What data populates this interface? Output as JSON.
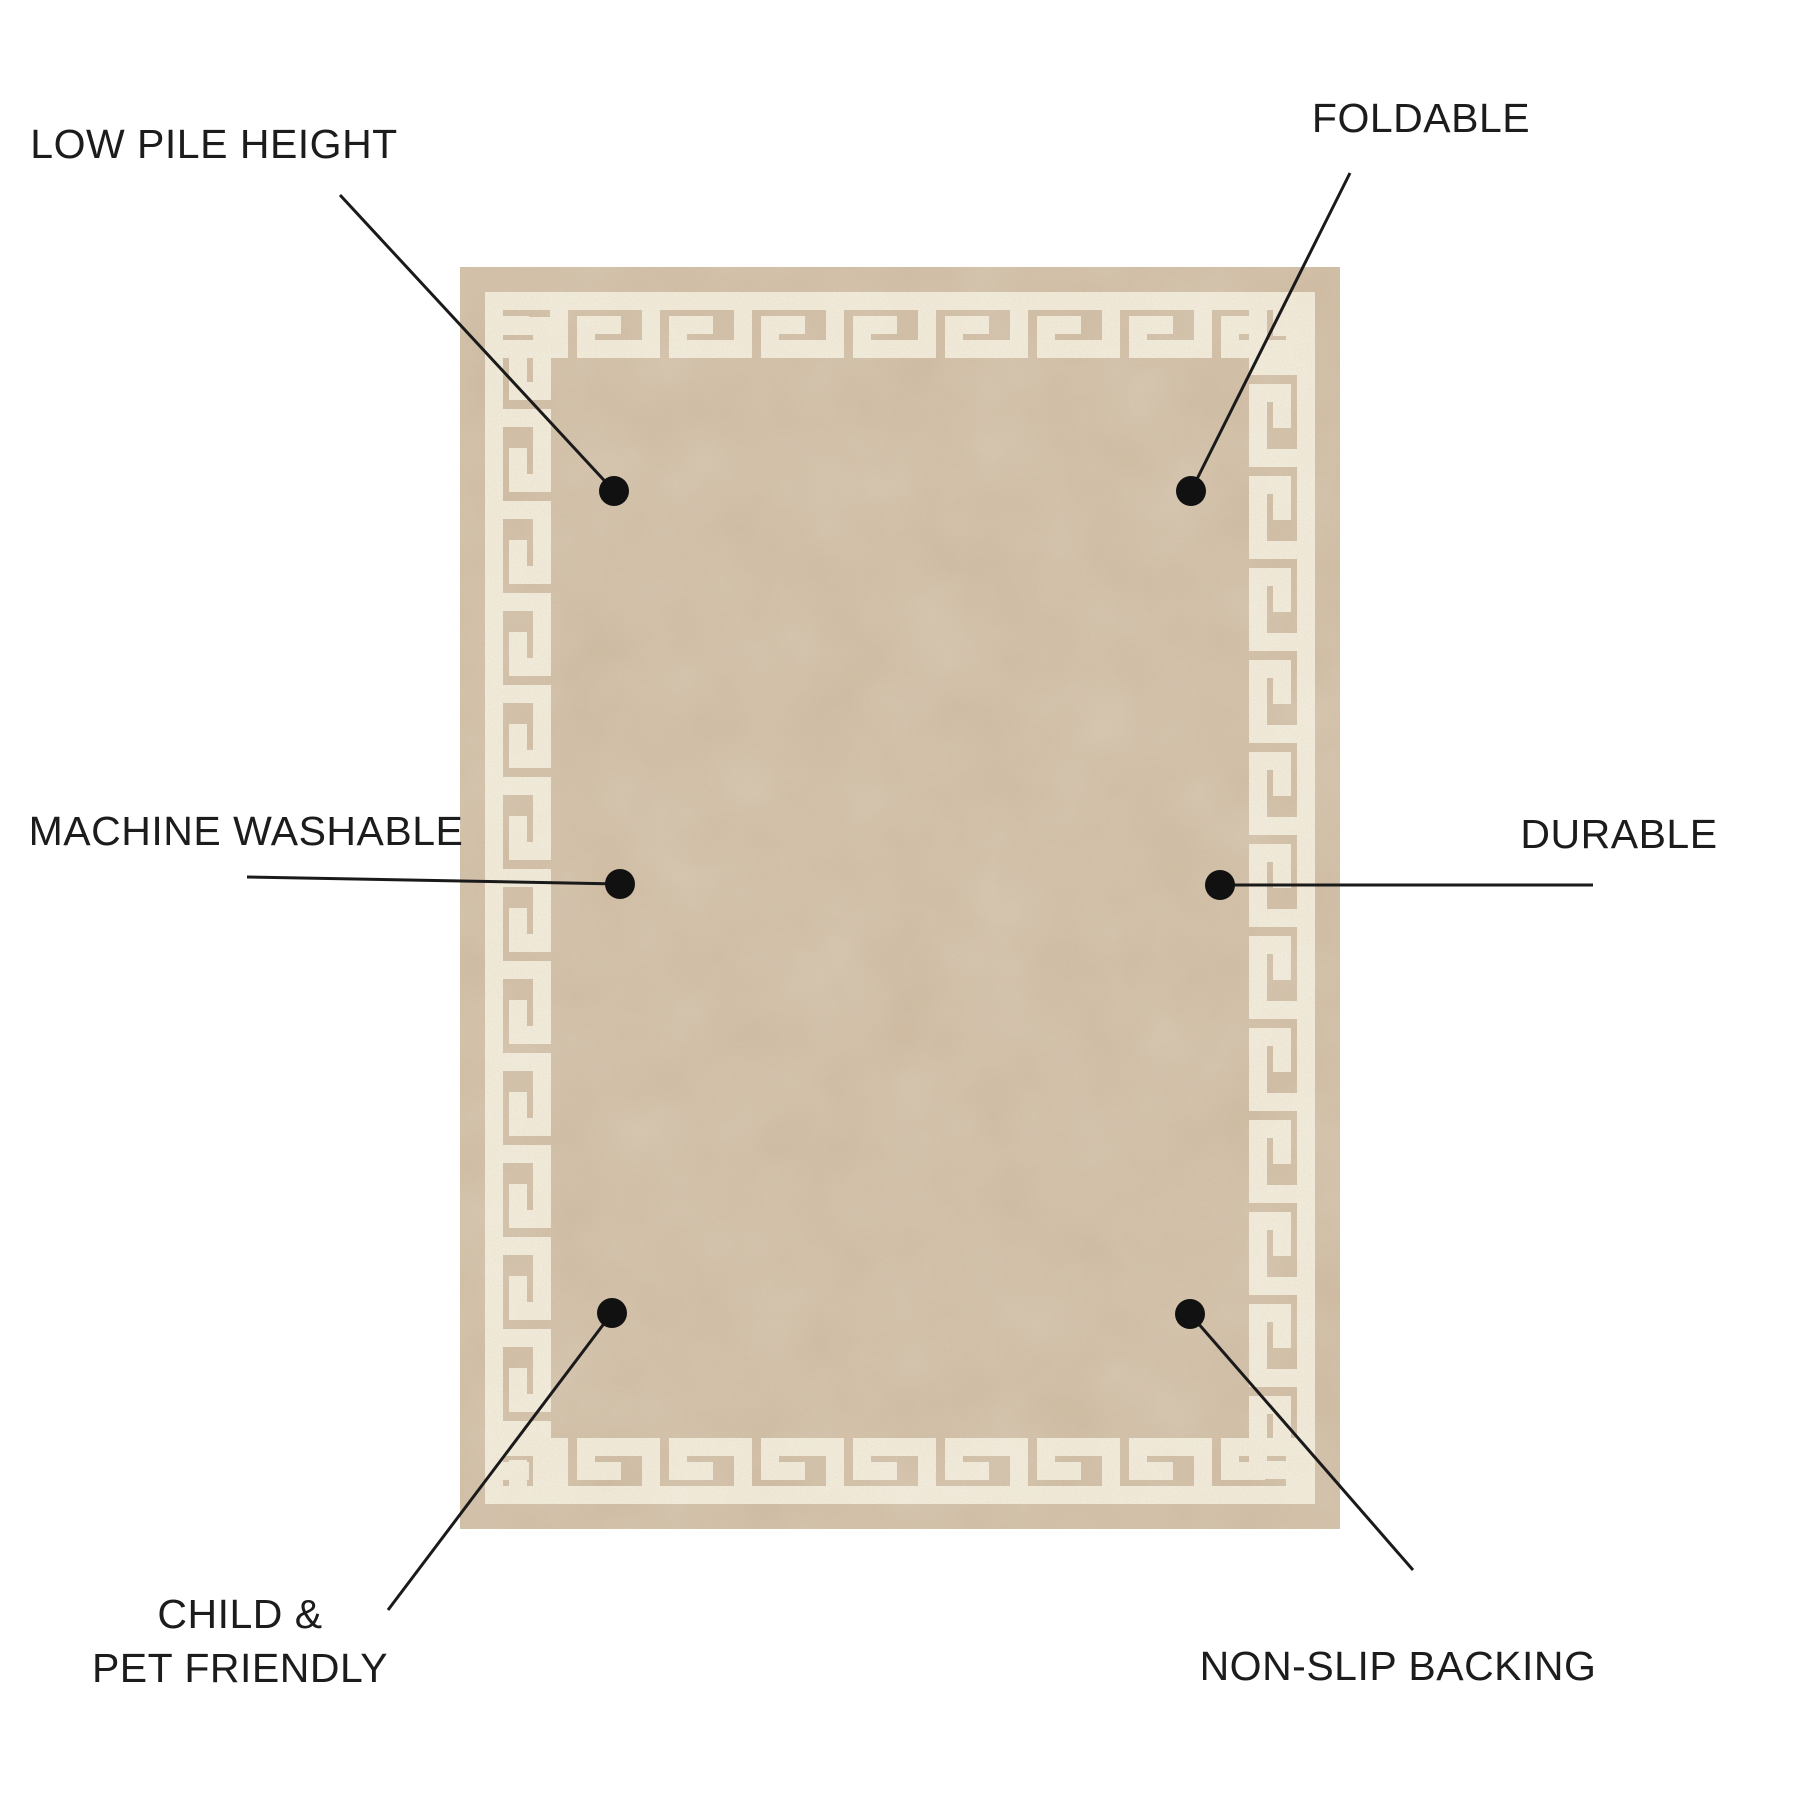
{
  "figure": {
    "type": "product-feature-diagram",
    "subject": "beige rug with greek key border"
  },
  "colors": {
    "background": "#ffffff",
    "text": "#1c1c1c",
    "line": "#1a1a1a",
    "dot": "#111111",
    "rug_base": "#cfbba1",
    "pattern_cream": "#f3ecda",
    "grain_tint": "#73614c",
    "patch_tint": "#faf5e9"
  },
  "rug": {
    "left": 460,
    "top": 267,
    "width": 880,
    "height": 1262,
    "border_margin": 25,
    "band_thickness": 66,
    "frame_stroke": 18,
    "meander_repeat": 92
  },
  "callouts": [
    {
      "name": "low-pile-height",
      "label": "LOW PILE HEIGHT",
      "label_center": {
        "x": 214,
        "y": 144
      },
      "line": {
        "x1": 340,
        "y1": 195,
        "x2": 614,
        "y2": 491
      },
      "dot": {
        "x": 614,
        "y": 491,
        "r": 15
      }
    },
    {
      "name": "foldable",
      "label": "FOLDABLE",
      "label_center": {
        "x": 1421,
        "y": 118
      },
      "line": {
        "x1": 1350,
        "y1": 173,
        "x2": 1191,
        "y2": 491
      },
      "dot": {
        "x": 1191,
        "y": 491,
        "r": 15
      }
    },
    {
      "name": "machine-washable",
      "label": "MACHINE WASHABLE",
      "label_center": {
        "x": 246,
        "y": 831
      },
      "line": {
        "x1": 247,
        "y1": 877,
        "x2": 620,
        "y2": 884
      },
      "dot": {
        "x": 620,
        "y": 884,
        "r": 15
      }
    },
    {
      "name": "durable",
      "label": "DURABLE",
      "label_center": {
        "x": 1619,
        "y": 834
      },
      "line": {
        "x1": 1593,
        "y1": 885,
        "x2": 1220,
        "y2": 885
      },
      "dot": {
        "x": 1220,
        "y": 885,
        "r": 15
      }
    },
    {
      "name": "child-pet-friendly",
      "label": "CHILD &\nPET FRIENDLY",
      "label_center": {
        "x": 240,
        "y": 1641
      },
      "line": {
        "x1": 388,
        "y1": 1610,
        "x2": 612,
        "y2": 1313
      },
      "dot": {
        "x": 612,
        "y": 1313,
        "r": 15
      }
    },
    {
      "name": "non-slip-backing",
      "label": "NON-SLIP BACKING",
      "label_center": {
        "x": 1398,
        "y": 1666
      },
      "line": {
        "x1": 1413,
        "y1": 1570,
        "x2": 1190,
        "y2": 1314
      },
      "dot": {
        "x": 1190,
        "y": 1314,
        "r": 15
      }
    }
  ]
}
